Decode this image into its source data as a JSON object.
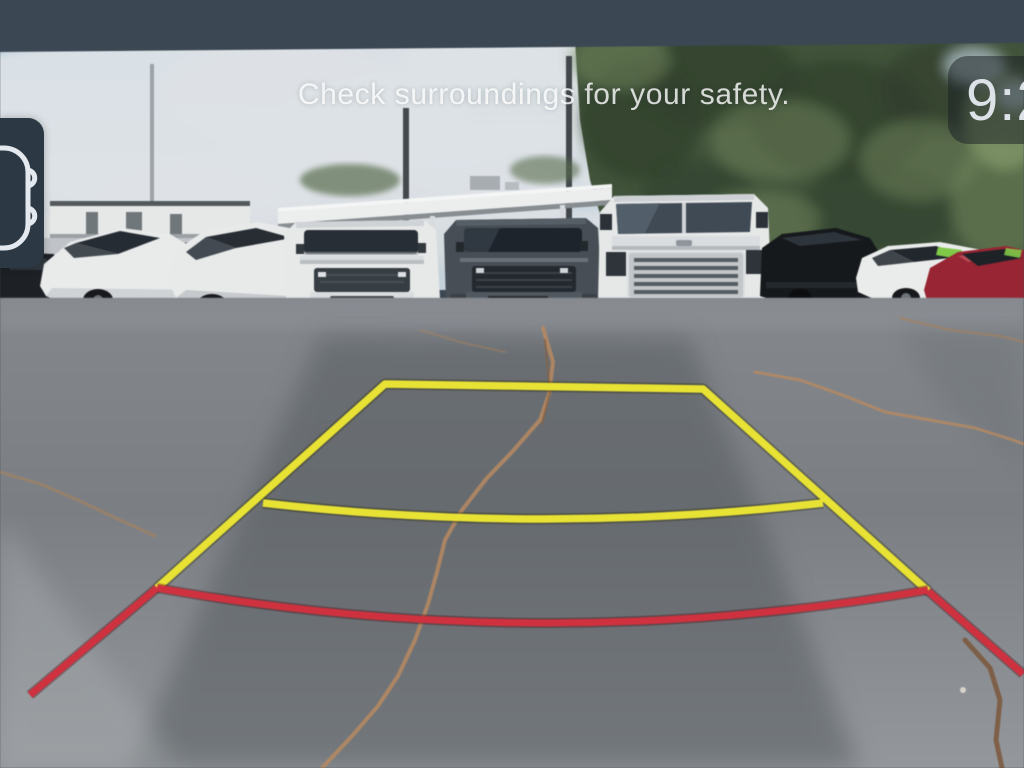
{
  "rear_camera_view": {
    "warning_text": "Check surroundings for your safety.",
    "clock": {
      "visible_time": "9:2"
    },
    "camera_view_button": {
      "icon": "car-top-view-icon"
    },
    "guidelines": {
      "steering_zone_color_yellow": "#e9e22e",
      "limit_zone_color_red": "#d4303e"
    },
    "letterbox_band_color": "#3b4754"
  }
}
